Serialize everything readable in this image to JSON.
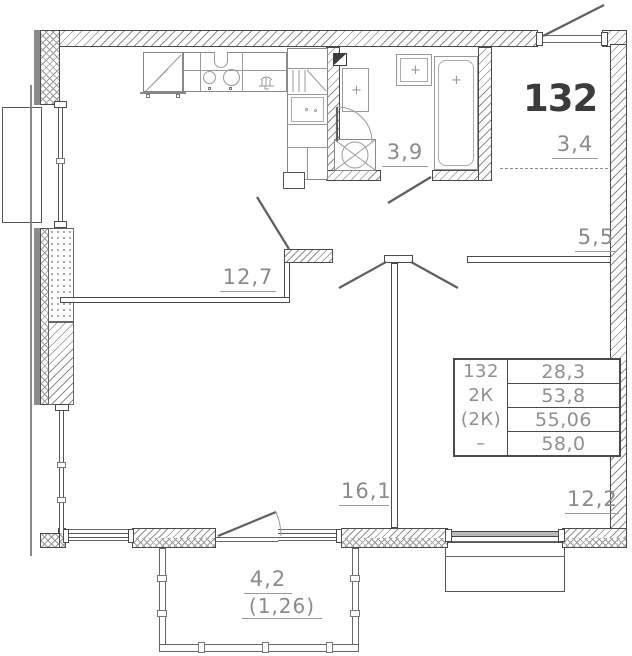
{
  "plan": {
    "apartment_number": "132",
    "labels": {
      "kitchen_living": "12,7",
      "bathroom": "3,9",
      "hallway": "3,4",
      "corridor": "5,5",
      "bedroom_1": "16,1",
      "bedroom_2": "12,2",
      "balcony": "4,2",
      "balcony_reduced": "(1,26)"
    },
    "info_table": {
      "rows": [
        {
          "label": "132",
          "value": "28,3"
        },
        {
          "label": "2К",
          "value": "53,8"
        },
        {
          "label": "(2К)",
          "value": "55,06"
        },
        {
          "label": "–",
          "value": "58,0"
        }
      ]
    },
    "colors": {
      "wall_line": "#4a4a4a",
      "hatch": "#8f8f8f",
      "label_text": "#8a8a8a",
      "apartment_number_text": "#3b3b3b"
    }
  }
}
